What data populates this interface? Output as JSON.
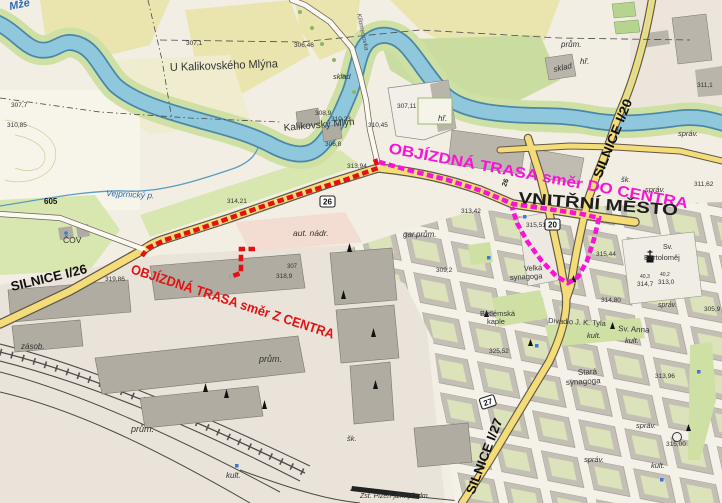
{
  "map": {
    "kind": "topographic city map with detour routes",
    "colors": {
      "route_from_center": "#e31111",
      "route_to_center": "#f714d4",
      "river": "#8fc8dc",
      "main_road": "#f4dc78",
      "field": "#eae5af",
      "park": "#cfe0a4",
      "block": "#c3bfb4",
      "courtyard": "#dce2ba"
    }
  },
  "routes": [
    {
      "name": "detour-route-from-center",
      "color": "#e31111",
      "points": [
        [
          375,
          159
        ],
        [
          378,
          168
        ],
        [
          345,
          180
        ],
        [
          300,
          194
        ],
        [
          258,
          208
        ],
        [
          230,
          218
        ],
        [
          196,
          230
        ],
        [
          165,
          240
        ],
        [
          148,
          248
        ],
        [
          142,
          256
        ]
      ],
      "spur": [
        [
          255,
          249
        ],
        [
          241,
          249
        ],
        [
          241,
          273
        ],
        [
          230,
          277
        ]
      ]
    },
    {
      "name": "detour-route-to-center",
      "color": "#f714d4",
      "points": [
        [
          379,
          162
        ],
        [
          412,
          171
        ],
        [
          448,
          180
        ],
        [
          482,
          191
        ],
        [
          513,
          204
        ],
        [
          548,
          209
        ],
        [
          582,
          214
        ],
        [
          599,
          218
        ],
        [
          594,
          239
        ],
        [
          587,
          261
        ],
        [
          578,
          277
        ],
        [
          568,
          283
        ],
        [
          556,
          276
        ],
        [
          541,
          260
        ],
        [
          527,
          241
        ],
        [
          517,
          223
        ],
        [
          512,
          207
        ]
      ]
    }
  ],
  "road_shields": [
    {
      "n": "26",
      "x": 320,
      "y": 196,
      "r": 0
    },
    {
      "n": "20",
      "x": 545,
      "y": 219,
      "r": 0
    },
    {
      "n": "27",
      "x": 479,
      "y": 399,
      "r": -18
    }
  ],
  "map_labels": [
    {
      "n": "route-label-to-center",
      "t": "OBJÍZDNÁ TRASA směr DO CENTRA",
      "x": 388,
      "y": 153,
      "s": 15,
      "r": 10.5,
      "tl": 304,
      "b": 1,
      "f": "#f714d4"
    },
    {
      "n": "route-label-from-center",
      "t": "OBJÍZDNÁ TRASA směr Z CENTRA",
      "x": 130,
      "y": 273,
      "s": 13.5,
      "r": 18,
      "tl": 213,
      "b": 1,
      "f": "#e31111"
    },
    {
      "n": "road-label-i26",
      "t": "SILNICE I/26",
      "x": 12,
      "y": 291,
      "s": 13,
      "r": -13.5,
      "tl": 78,
      "b": 1,
      "f": "#111111"
    },
    {
      "n": "road-label-i20",
      "t": "SILNICE I/20",
      "x": 601,
      "y": 179,
      "s": 13,
      "r": -68,
      "tl": 84,
      "b": 1,
      "f": "#111111"
    },
    {
      "n": "road-label-i27",
      "t": "SILNICE I/27",
      "x": 474,
      "y": 495,
      "s": 13,
      "r": -69,
      "tl": 80,
      "b": 1,
      "f": "#111111"
    },
    {
      "n": "inner-city-label",
      "t": "VNITŘNÍ MĚSTO",
      "x": 518,
      "y": 203,
      "s": 16,
      "r": 4.5,
      "tl": 160,
      "b": 1,
      "f": "#1d1d1d"
    },
    {
      "n": "road-number-605",
      "t": "605",
      "x": 44,
      "y": 204,
      "s": 8,
      "b": 1,
      "f": "#111111"
    },
    {
      "n": "road-number-26-on-road",
      "t": "26",
      "x": 506,
      "y": 187,
      "s": 7,
      "b": 1,
      "r": -70,
      "f": "#222222"
    },
    {
      "n": "place-label",
      "t": "U Kalikovského Mlýna",
      "x": 170,
      "y": 71,
      "s": 11.5,
      "r": -2,
      "tl": 108
    },
    {
      "n": "place-label",
      "t": "Kalikovský Mlýn",
      "x": 284,
      "y": 131,
      "s": 10,
      "r": -5,
      "tl": 71
    },
    {
      "n": "place-label",
      "t": "Sv. Anna",
      "x": 618,
      "y": 331,
      "s": 8,
      "r": 3
    },
    {
      "n": "place-label",
      "t": "Divadlo J. K. Tyla",
      "x": 548,
      "y": 323,
      "s": 7.5,
      "r": 3
    },
    {
      "n": "place-label",
      "t": "Stará",
      "x": 578,
      "y": 375,
      "s": 8,
      "r": -3
    },
    {
      "n": "place-label",
      "t": "synagoga",
      "x": 566,
      "y": 385,
      "s": 8,
      "r": -3
    },
    {
      "n": "place-label",
      "t": "Velká",
      "x": 524,
      "y": 271,
      "s": 7.5,
      "r": -3
    },
    {
      "n": "place-label",
      "t": "synagoga",
      "x": 510,
      "y": 280,
      "s": 7.5,
      "r": -3
    },
    {
      "n": "place-label",
      "t": "Betlémská",
      "x": 480,
      "y": 316,
      "s": 7.5
    },
    {
      "n": "place-label",
      "t": "kaple",
      "x": 487,
      "y": 324,
      "s": 7.5
    },
    {
      "n": "place-label",
      "t": "Sv.",
      "x": 663,
      "y": 249,
      "s": 7
    },
    {
      "n": "place-label",
      "t": "Bartoloměj",
      "x": 644,
      "y": 260,
      "s": 7.5
    },
    {
      "n": "place-label",
      "t": "Zst. Plzeň-jižní předm.",
      "x": 360,
      "y": 498,
      "s": 7,
      "i": 1
    },
    {
      "n": "place-label",
      "t": "Kilometrovka",
      "x": 357,
      "y": 14,
      "s": 6.5,
      "r": 78,
      "i": 1,
      "f": "#555555"
    },
    {
      "n": "facility-label",
      "t": "aut. nádr.",
      "x": 293,
      "y": 236,
      "s": 8.5,
      "i": 1
    },
    {
      "n": "facility-label",
      "t": "sklad",
      "x": 554,
      "y": 72,
      "s": 8,
      "i": 1,
      "r": -12
    },
    {
      "n": "facility-label",
      "t": "sklad",
      "x": 333,
      "y": 79,
      "s": 7.5,
      "i": 1
    },
    {
      "n": "facility-label",
      "t": "prům.",
      "x": 561,
      "y": 47,
      "s": 8,
      "i": 1
    },
    {
      "n": "facility-label",
      "t": "gar.",
      "x": 403,
      "y": 237,
      "s": 8,
      "i": 1
    },
    {
      "n": "facility-label",
      "t": "prům.",
      "x": 416,
      "y": 237,
      "s": 8,
      "i": 1
    },
    {
      "n": "facility-label",
      "t": "prům.",
      "x": 259,
      "y": 362,
      "s": 9,
      "i": 1
    },
    {
      "n": "facility-label",
      "t": "prům.",
      "x": 131,
      "y": 432,
      "s": 9,
      "i": 1
    },
    {
      "n": "facility-label",
      "t": "zásob.",
      "x": 21,
      "y": 349,
      "s": 8,
      "i": 1
    },
    {
      "n": "facility-label",
      "t": "ČOV",
      "x": 63,
      "y": 243,
      "s": 8.5
    },
    {
      "n": "facility-label",
      "t": "kult.",
      "x": 587,
      "y": 338,
      "s": 7.5,
      "i": 1
    },
    {
      "n": "facility-label",
      "t": "kult.",
      "x": 625,
      "y": 343,
      "s": 7.5,
      "i": 1
    },
    {
      "n": "facility-label",
      "t": "kult.",
      "x": 226,
      "y": 478,
      "s": 8,
      "i": 1
    },
    {
      "n": "facility-label",
      "t": "kult.",
      "x": 651,
      "y": 468,
      "s": 7.5,
      "i": 1
    },
    {
      "n": "facility-label",
      "t": "správ.",
      "x": 678,
      "y": 136,
      "s": 7.5,
      "i": 1
    },
    {
      "n": "facility-label",
      "t": "správ.",
      "x": 645,
      "y": 192,
      "s": 7.5,
      "i": 1
    },
    {
      "n": "facility-label",
      "t": "správ.",
      "x": 584,
      "y": 462,
      "s": 7.5,
      "i": 1
    },
    {
      "n": "facility-label",
      "t": "správ.",
      "x": 636,
      "y": 428,
      "s": 7.5,
      "i": 1
    },
    {
      "n": "facility-label",
      "t": "správ.",
      "x": 658,
      "y": 307,
      "s": 7,
      "i": 1
    },
    {
      "n": "facility-label",
      "t": "šk.",
      "x": 621,
      "y": 182,
      "s": 7.5,
      "i": 1
    },
    {
      "n": "facility-label",
      "t": "šk.",
      "x": 347,
      "y": 441,
      "s": 7.5,
      "i": 1
    },
    {
      "n": "facility-label",
      "t": "hř.",
      "x": 438,
      "y": 121,
      "s": 8,
      "i": 1
    },
    {
      "n": "facility-label",
      "t": "hř.",
      "x": 580,
      "y": 64,
      "s": 8,
      "i": 1
    },
    {
      "n": "river-label",
      "t": "Mže",
      "x": 10,
      "y": 10,
      "s": 11,
      "i": 1,
      "b": 1,
      "r": -12,
      "f": "#2b6bb5"
    },
    {
      "n": "stream-label",
      "t": "Vejprnický p.",
      "x": 106,
      "y": 196,
      "s": 8.5,
      "i": 1,
      "r": 3,
      "f": "#2b6bb5"
    },
    {
      "n": "elevation-label",
      "t": "307,1",
      "x": 186,
      "y": 45,
      "s": 6.5
    },
    {
      "n": "elevation-label",
      "t": "306,46",
      "x": 294,
      "y": 47,
      "s": 6.5
    },
    {
      "n": "elevation-label",
      "t": "307,7",
      "x": 11,
      "y": 107,
      "s": 6.5
    },
    {
      "n": "elevation-label",
      "t": "310,85",
      "x": 7,
      "y": 127,
      "s": 6.5
    },
    {
      "n": "elevation-label",
      "t": "308,9",
      "x": 315,
      "y": 115,
      "s": 6.5
    },
    {
      "n": "elevation-label",
      "t": "310,23",
      "x": 331,
      "y": 121,
      "s": 6.5
    },
    {
      "n": "elevation-label",
      "t": "310,45",
      "x": 368,
      "y": 127,
      "s": 6.5
    },
    {
      "n": "elevation-label",
      "t": "306,8",
      "x": 325,
      "y": 146,
      "s": 6.5
    },
    {
      "n": "elevation-label",
      "t": "307,11",
      "x": 397,
      "y": 108,
      "s": 6.5
    },
    {
      "n": "elevation-label",
      "t": "313,94",
      "x": 347,
      "y": 168,
      "s": 6.5
    },
    {
      "n": "elevation-label",
      "t": "314,21",
      "x": 227,
      "y": 203,
      "s": 6.5
    },
    {
      "n": "elevation-label",
      "t": "318,9",
      "x": 276,
      "y": 278,
      "s": 6.5
    },
    {
      "n": "elevation-label",
      "t": "307",
      "x": 287,
      "y": 268,
      "s": 6
    },
    {
      "n": "elevation-label",
      "t": "319,86",
      "x": 105,
      "y": 281,
      "s": 6.5
    },
    {
      "n": "elevation-label",
      "t": "315,51",
      "x": 526,
      "y": 227,
      "s": 6.5
    },
    {
      "n": "elevation-label",
      "t": "313,42",
      "x": 461,
      "y": 213,
      "s": 6.5
    },
    {
      "n": "elevation-label",
      "t": "309,2",
      "x": 436,
      "y": 272,
      "s": 6.5
    },
    {
      "n": "elevation-label",
      "t": "315,44",
      "x": 596,
      "y": 256,
      "s": 6.5
    },
    {
      "n": "elevation-label",
      "t": "314,7",
      "x": 637,
      "y": 286,
      "s": 6.5
    },
    {
      "n": "elevation-label",
      "t": "313,0",
      "x": 658,
      "y": 284,
      "s": 6.5
    },
    {
      "n": "elevation-label",
      "t": "40,3",
      "x": 640,
      "y": 278,
      "s": 5
    },
    {
      "n": "elevation-label",
      "t": "40,2",
      "x": 660,
      "y": 276,
      "s": 5
    },
    {
      "n": "elevation-label",
      "t": "314,80",
      "x": 601,
      "y": 302,
      "s": 6.5
    },
    {
      "n": "elevation-label",
      "t": "311,62",
      "x": 694,
      "y": 186,
      "s": 6.5
    },
    {
      "n": "elevation-label",
      "t": "313,96",
      "x": 655,
      "y": 378,
      "s": 6.5
    },
    {
      "n": "elevation-label",
      "t": "325,52",
      "x": 489,
      "y": 353,
      "s": 6.5
    },
    {
      "n": "elevation-label",
      "t": "305,9",
      "x": 704,
      "y": 311,
      "s": 6.5
    },
    {
      "n": "elevation-label",
      "t": "311,1",
      "x": 697,
      "y": 87,
      "s": 6.5
    },
    {
      "n": "elevation-label",
      "t": "315,00",
      "x": 666,
      "y": 446,
      "s": 6.5
    }
  ]
}
